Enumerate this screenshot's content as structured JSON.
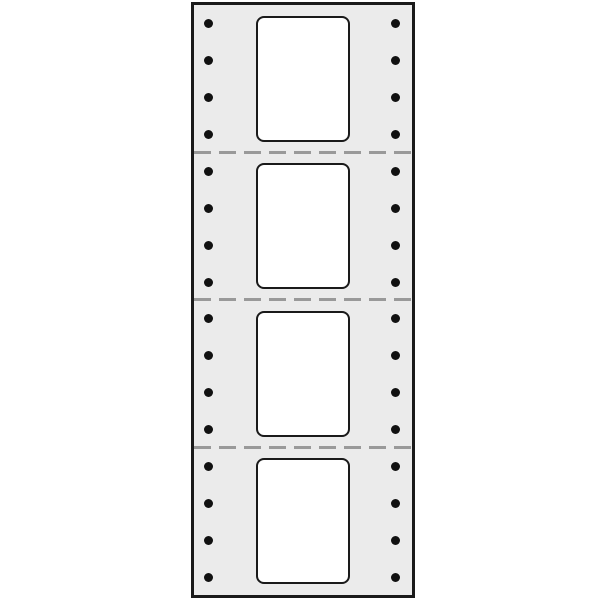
{
  "figure": {
    "type": "pin-feed-continuous-label-sheet",
    "section_count": 4,
    "labels_per_sheet": 4,
    "perforation_count": 3,
    "holes_per_side_per_section": 4,
    "hole_columns": [
      "left",
      "right"
    ],
    "colors": {
      "background": "#ffffff",
      "paper": "#ebebeb",
      "outline": "#1a1a1a",
      "label": "#ffffff",
      "hole": "#111111",
      "perforation": "#999999"
    }
  }
}
